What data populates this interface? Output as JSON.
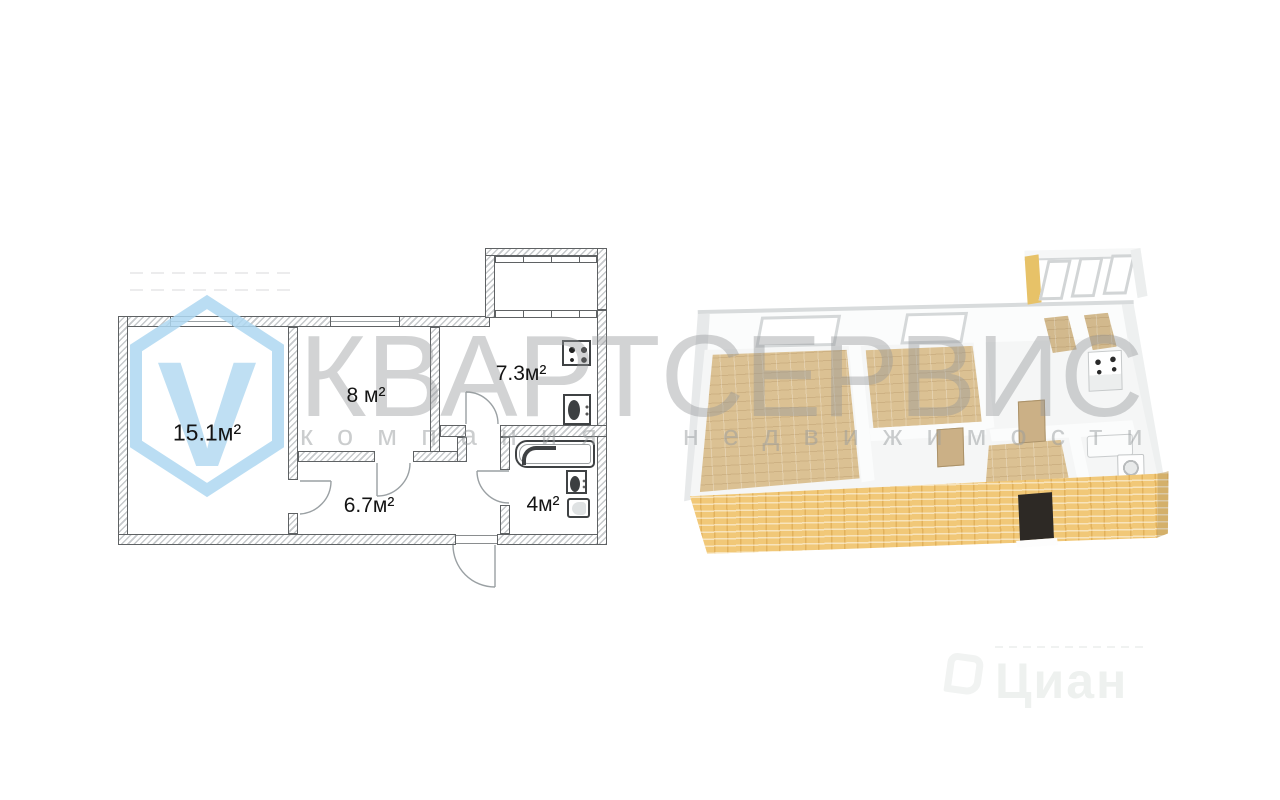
{
  "watermark": {
    "brand": "КВАРТСЕРВИС",
    "tagline": "компания недвижимости",
    "logo_letter": "V",
    "cian_label": "Циан"
  },
  "plan2d": {
    "type": "2d-floor-plan",
    "rooms": [
      {
        "id": "living-room",
        "label": "15.1м²",
        "area_m2": 15.1
      },
      {
        "id": "bedroom",
        "label": "8 м²",
        "area_m2": 8
      },
      {
        "id": "kitchen",
        "label": "7.3м²",
        "area_m2": 7.3
      },
      {
        "id": "hallway",
        "label": "6.7м²",
        "area_m2": 6.7
      },
      {
        "id": "bathroom",
        "label": "4м²",
        "area_m2": 4
      }
    ],
    "fixtures": [
      "stove",
      "kitchen-sink",
      "bathtub",
      "washbasin",
      "toilet"
    ],
    "features": [
      "balcony",
      "windows",
      "door-swings",
      "entrance-door"
    ]
  },
  "plan3d": {
    "type": "3d-floor-plan",
    "colors": {
      "exterior_brick": "#f1c878",
      "wood_floor": "#dbc193",
      "interior_walls": "#fbfcfc",
      "entrance_door": "#2d2925",
      "balcony_wall": "#e7c268"
    },
    "features": [
      "balcony-windows",
      "stove",
      "bathtub",
      "washing-machine",
      "interior-doors",
      "entrance-door"
    ]
  },
  "colors": {
    "logo_blue": "#aed8f1",
    "watermark_gray": "#97999b",
    "plan_line": "#55585a",
    "background": "#ffffff"
  }
}
